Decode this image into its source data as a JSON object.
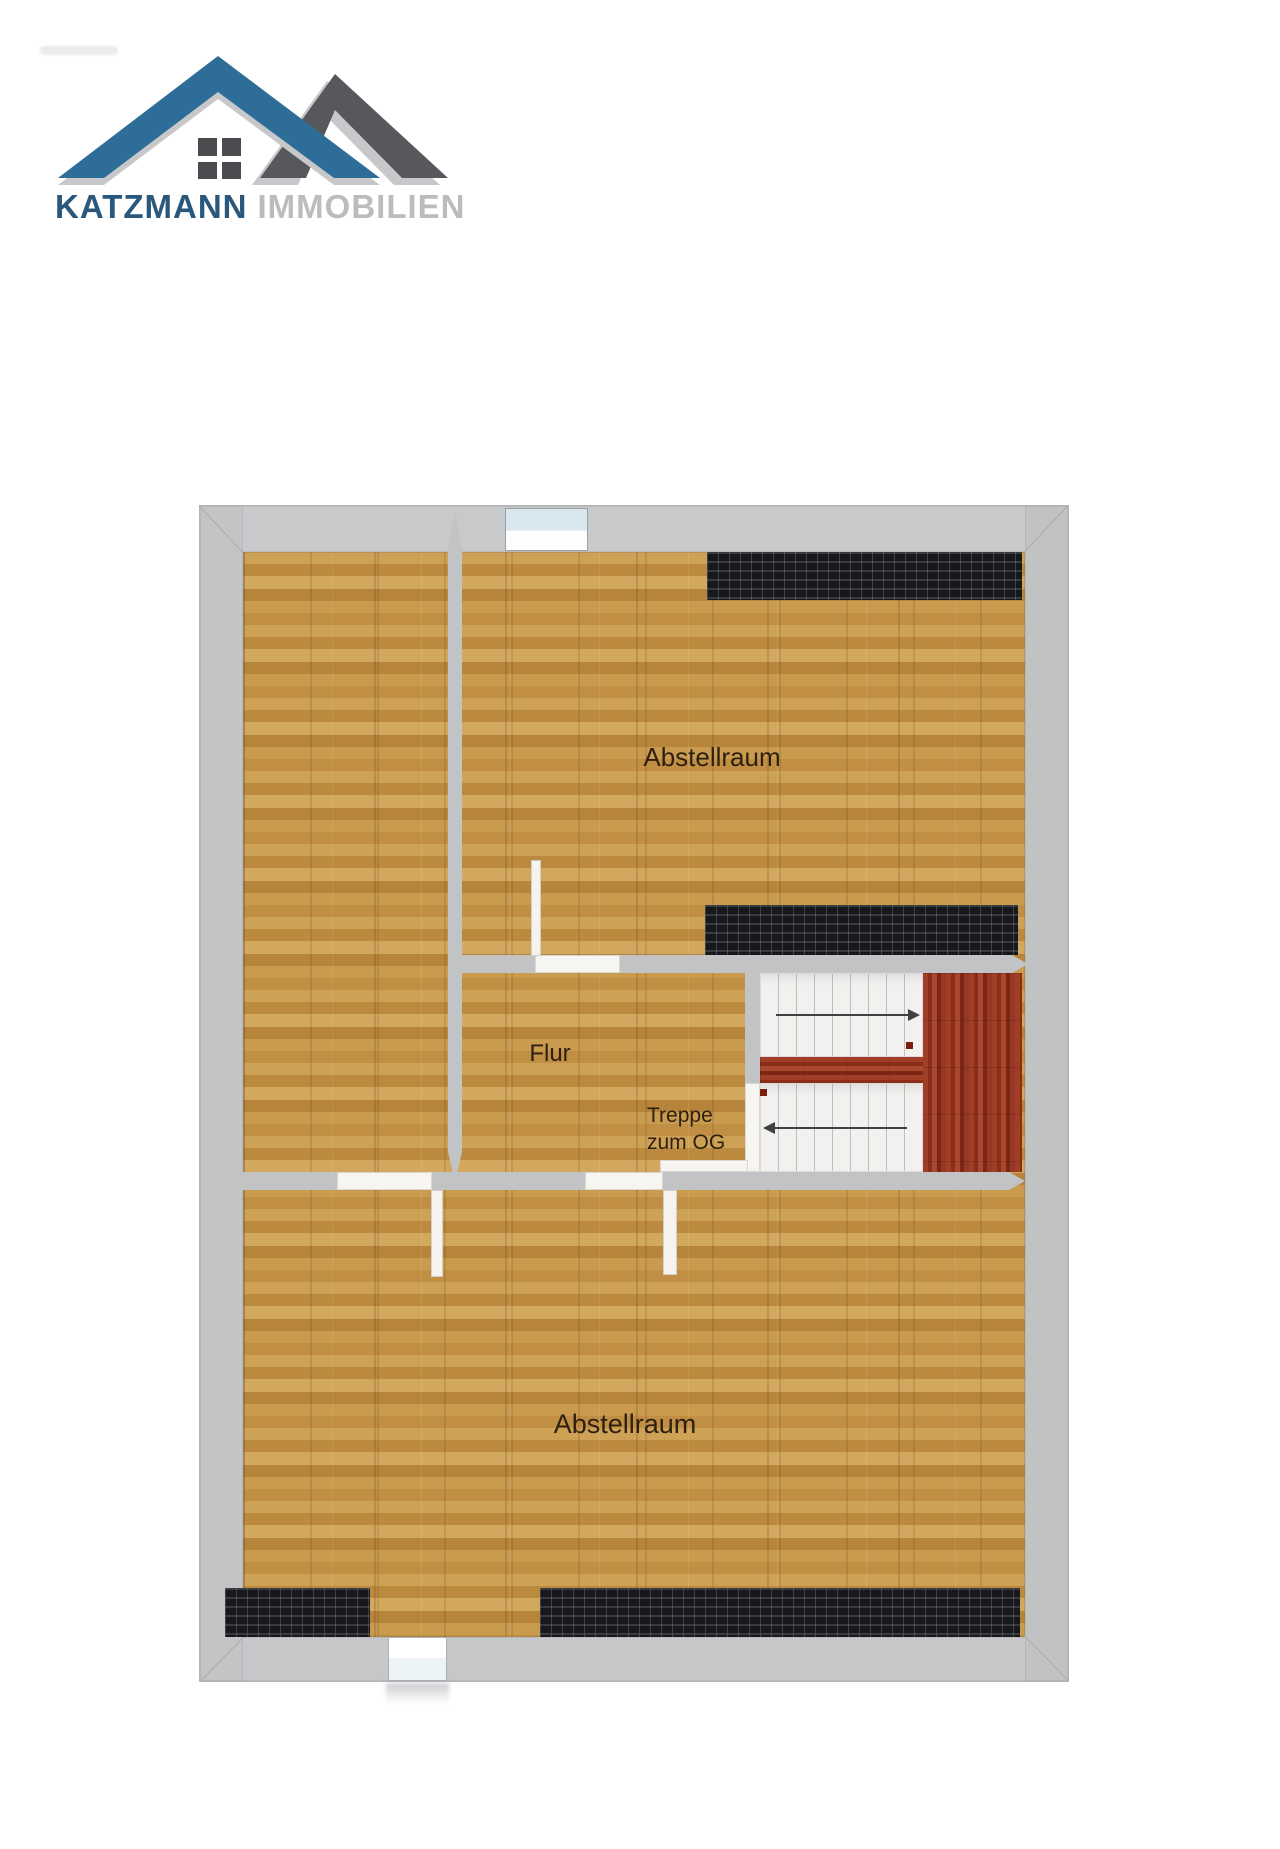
{
  "logo": {
    "brand_primary": "KATZMANN",
    "brand_secondary": "IMMOBILIEN",
    "colors": {
      "roof_blue": "#2d6d98",
      "roof_gray": "#57585c",
      "shadow_gray": "#c7c8ca",
      "text_blue": "#2a587c",
      "text_gray": "#bbbcbe"
    }
  },
  "floorplan": {
    "rooms": [
      {
        "id": "abstellraum-top",
        "label": "Abstellraum"
      },
      {
        "id": "flur",
        "label": "Flur"
      },
      {
        "id": "abstellraum-bottom",
        "label": "Abstellraum"
      }
    ],
    "stairs": {
      "label_line1": "Treppe",
      "label_line2": "zum OG",
      "direction_up": "right",
      "direction_down": "left"
    },
    "colors": {
      "wall": "#c5c6c8",
      "floor_oak": "#c69a4e",
      "stair_wood": "#92321d",
      "knee_wall_hatch": "#17181b",
      "window_glass": "#d9e8f0",
      "label_text": "#2e1f10"
    }
  }
}
